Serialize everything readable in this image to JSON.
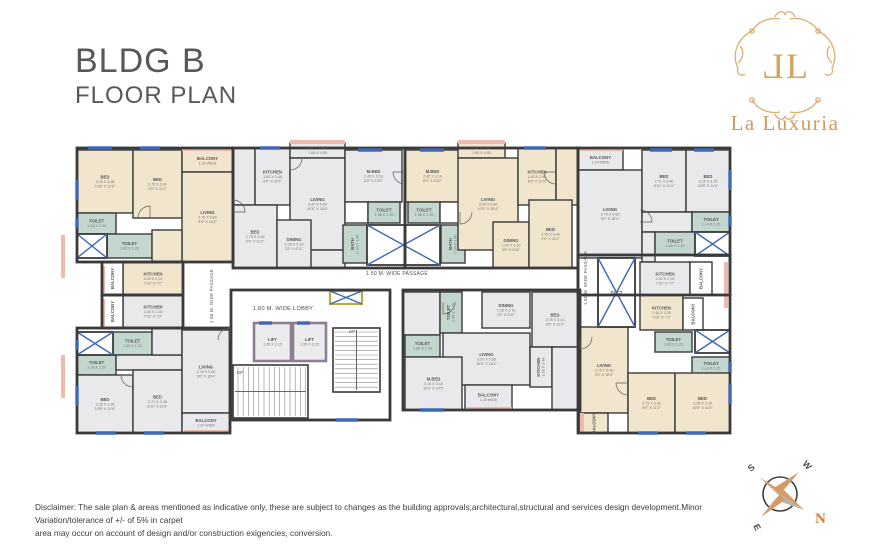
{
  "title": {
    "line1": "BLDG B",
    "line2": "FLOOR PLAN"
  },
  "logo": {
    "mono_left": "L",
    "mono_right": "L",
    "name": "La Luxuria",
    "gold": "#d9a55e"
  },
  "disclaimer": {
    "line1": "Disclaimer: The sale plan & areas mentioned as indicative only, these are subject to changes as the building approvals,architectural,structural and services design development.Minor Variation/tolerance of +/- of 5% in carpet",
    "line2": "area may occur on account of design and/or construction exigencies, conversion."
  },
  "compass": {
    "n": "N",
    "s": "S",
    "e": "E",
    "w": "W"
  },
  "colors": {
    "wall": "#3a3a3a",
    "cream": "#f1e5cd",
    "gray": "#e9e9eb",
    "teal": "#c3d7cf",
    "white": "#ffffff",
    "window": "#3f67b5",
    "rail": "#f0b9ad",
    "lift_border": "#8d7d95",
    "duct_yellow": "#b9a84e",
    "label": "#555555",
    "dims": "#76736e"
  },
  "plan": {
    "rooms": [
      {
        "ls": [
          "BED",
          "3.25 X 3.35",
          "10'8\" X 11'0\""
        ],
        "x": 77,
        "y": 150,
        "w": 56,
        "h": 63,
        "f": "c"
      },
      {
        "ls": [
          "BED",
          "2.75 X 3.41",
          "9'0\" X 11'2\""
        ],
        "x": 133,
        "y": 150,
        "w": 49,
        "h": 68,
        "f": "c"
      },
      {
        "ls": [
          "BALCONY",
          "1.20 WIDE"
        ],
        "x": 182,
        "y": 150,
        "w": 51,
        "h": 22,
        "f": "c"
      },
      {
        "ls": [
          "LIVING",
          "2.75 X 5.60",
          "9'0\" X 18'4\""
        ],
        "x": 182,
        "y": 172,
        "w": 51,
        "h": 90,
        "f": "c"
      },
      {
        "ls": [
          "TOILET",
          "1.14 X 2.20"
        ],
        "x": 77,
        "y": 213,
        "w": 39,
        "h": 21,
        "f": "t"
      },
      {
        "ls": [
          "TOILET",
          "1.85 X 1.20"
        ],
        "x": 107,
        "y": 234,
        "w": 45,
        "h": 24,
        "f": "t"
      },
      {
        "ls": [],
        "x": 152,
        "y": 230,
        "w": 30,
        "h": 32,
        "f": "c"
      },
      {
        "ls": [
          "KITCHEN",
          "2.40 X 2.20",
          "7'10\" X 7'2\""
        ],
        "x": 123,
        "y": 262,
        "w": 60,
        "h": 33,
        "f": "c"
      },
      {
        "ls": [
          "BALCONY"
        ],
        "x": 102,
        "y": 262,
        "w": 21,
        "h": 33,
        "f": "w",
        "vert": true
      },
      {
        "ls": [],
        "x": 233,
        "y": 148,
        "w": 22,
        "h": 57,
        "f": "g"
      },
      {
        "ls": [
          "KITCHEN",
          "1.83 X 3.48",
          "6'0\" X 11'5\""
        ],
        "x": 255,
        "y": 148,
        "w": 35,
        "h": 57,
        "f": "g"
      },
      {
        "ls": [
          "BALCONY",
          "1.06 X 4.05"
        ],
        "x": 290,
        "y": 143,
        "w": 55,
        "h": 15,
        "f": "g"
      },
      {
        "ls": [
          "LIVING",
          "3.20 X 5.60",
          "10'6\" X 18'4\""
        ],
        "x": 290,
        "y": 158,
        "w": 55,
        "h": 92,
        "f": "g"
      },
      {
        "ls": [],
        "x": 290,
        "y": 250,
        "w": 55,
        "h": 18,
        "f": "g"
      },
      {
        "ls": [
          "BED",
          "2.75 X 3.40",
          "9'0\" X 11'2\""
        ],
        "x": 233,
        "y": 205,
        "w": 44,
        "h": 63,
        "f": "g"
      },
      {
        "ls": [
          "DINING",
          "1.05 X 2.10",
          "3'5\" X 6'11\""
        ],
        "x": 277,
        "y": 220,
        "w": 34,
        "h": 48,
        "f": "g"
      },
      {
        "ls": [
          "M.BED",
          "2.45 X 3.10",
          "8'0\" X 10'2\""
        ],
        "x": 345,
        "y": 150,
        "w": 57,
        "h": 52,
        "f": "g"
      },
      {
        "ls": [],
        "x": 345,
        "y": 202,
        "w": 23,
        "h": 21,
        "f": "w"
      },
      {
        "ls": [
          "TOILET",
          "1.36 X 2.20"
        ],
        "x": 368,
        "y": 202,
        "w": 32,
        "h": 21,
        "f": "t"
      },
      {
        "ls": [
          "BATH",
          "0.94 X 1.80"
        ],
        "x": 343,
        "y": 225,
        "w": 24,
        "h": 38,
        "f": "t",
        "vert": true
      },
      {
        "ls": [
          "M.BED",
          "2.45 X 3.10",
          "8'0\" X 10'2\""
        ],
        "x": 405,
        "y": 150,
        "w": 55,
        "h": 52,
        "f": "c"
      },
      {
        "ls": [
          "TOILET",
          "1.36 X 2.20"
        ],
        "x": 408,
        "y": 202,
        "w": 32,
        "h": 21,
        "f": "t"
      },
      {
        "ls": [],
        "x": 440,
        "y": 202,
        "w": 23,
        "h": 21,
        "f": "w"
      },
      {
        "ls": [
          "BATH",
          "0.94 X 1.80"
        ],
        "x": 441,
        "y": 225,
        "w": 24,
        "h": 38,
        "f": "t",
        "vert": true
      },
      {
        "ls": [
          "BALCONY",
          "1.06 X 4.05"
        ],
        "x": 458,
        "y": 143,
        "w": 47,
        "h": 15,
        "f": "c"
      },
      {
        "ls": [
          "LIVING",
          "3.20 X 5.60",
          "10'6\" X 18'4\""
        ],
        "x": 458,
        "y": 158,
        "w": 60,
        "h": 92,
        "f": "c"
      },
      {
        "ls": [
          "KITCHEN",
          "1.83 X 3.48",
          "6'0\" X 11'5\""
        ],
        "x": 518,
        "y": 148,
        "w": 38,
        "h": 57,
        "f": "c"
      },
      {
        "ls": [],
        "x": 556,
        "y": 148,
        "w": 22,
        "h": 57,
        "f": "c"
      },
      {
        "ls": [
          "DINING",
          "1.05 X 2.10",
          "3'5\" X 6'11\""
        ],
        "x": 493,
        "y": 222,
        "w": 36,
        "h": 46,
        "f": "c"
      },
      {
        "ls": [
          "BED",
          "2.75 X 3.40",
          "9'0\" X 11'2\""
        ],
        "x": 529,
        "y": 200,
        "w": 43,
        "h": 68,
        "f": "c"
      },
      {
        "ls": [
          "BALCONY",
          "1.24 WIDE"
        ],
        "x": 578,
        "y": 150,
        "w": 45,
        "h": 20,
        "f": "g"
      },
      {
        "ls": [
          "LIVING",
          "2.75 X 5.60",
          "9'0\" X 18'4\""
        ],
        "x": 578,
        "y": 170,
        "w": 64,
        "h": 88,
        "f": "g"
      },
      {
        "ls": [
          "BED",
          "2.71 X 3.46",
          "8'11\" X 11'4\""
        ],
        "x": 642,
        "y": 150,
        "w": 44,
        "h": 62,
        "f": "g"
      },
      {
        "ls": [
          "BED",
          "3.25 X 3.35",
          "10'8\" X 11'0\""
        ],
        "x": 686,
        "y": 150,
        "w": 44,
        "h": 62,
        "f": "g"
      },
      {
        "ls": [],
        "x": 642,
        "y": 212,
        "w": 50,
        "h": 20,
        "f": "g"
      },
      {
        "ls": [],
        "x": 642,
        "y": 232,
        "w": 13,
        "h": 30,
        "f": "g"
      },
      {
        "ls": [
          "TOILET",
          "1.14 X 2.20"
        ],
        "x": 692,
        "y": 212,
        "w": 38,
        "h": 20,
        "f": "t"
      },
      {
        "ls": [
          "TOILET",
          "1.85 X 1.20"
        ],
        "x": 655,
        "y": 232,
        "w": 40,
        "h": 23,
        "f": "t"
      },
      {
        "ls": [
          "KITCHEN",
          "2.40 X 2.20",
          "7'10\" X 7'2\""
        ],
        "x": 640,
        "y": 262,
        "w": 50,
        "h": 33,
        "f": "g"
      },
      {
        "ls": [
          "BALCONY"
        ],
        "x": 690,
        "y": 262,
        "w": 22,
        "h": 33,
        "f": "w",
        "vert": true
      },
      {
        "ls": [
          "KITCHEN",
          "2.40 X 2.20",
          "7'10\" X 7'2\""
        ],
        "x": 123,
        "y": 295,
        "w": 60,
        "h": 33,
        "f": "g"
      },
      {
        "ls": [
          "BALCONY"
        ],
        "x": 102,
        "y": 295,
        "w": 21,
        "h": 33,
        "f": "w",
        "vert": true
      },
      {
        "ls": [
          "TOILET",
          "1.85 X 1.20"
        ],
        "x": 113,
        "y": 332,
        "w": 39,
        "h": 23,
        "f": "t"
      },
      {
        "ls": [
          "TOILET",
          "1.14 X 2.20"
        ],
        "x": 77,
        "y": 355,
        "w": 39,
        "h": 20,
        "f": "t"
      },
      {
        "ls": [],
        "x": 116,
        "y": 355,
        "w": 66,
        "h": 15,
        "f": "g"
      },
      {
        "ls": [],
        "x": 152,
        "y": 328,
        "w": 30,
        "h": 27,
        "f": "g"
      },
      {
        "ls": [
          "BED",
          "3.25 X 3.35",
          "10'8\" X 11'0\""
        ],
        "x": 77,
        "y": 375,
        "w": 56,
        "h": 58,
        "f": "g"
      },
      {
        "ls": [
          "BED",
          "2.71 X 3.46",
          "8'11\" X 11'4\""
        ],
        "x": 133,
        "y": 370,
        "w": 49,
        "h": 63,
        "f": "g"
      },
      {
        "ls": [
          "LIVING",
          "2.75 X 5.60",
          "9'0\" X 18'4\""
        ],
        "x": 182,
        "y": 330,
        "w": 48,
        "h": 83,
        "f": "g"
      },
      {
        "ls": [
          "BALCONY",
          "1.20 WIDE"
        ],
        "x": 182,
        "y": 413,
        "w": 48,
        "h": 20,
        "f": "g"
      },
      {
        "ls": [],
        "x": 403,
        "y": 292,
        "w": 37,
        "h": 43,
        "f": "g"
      },
      {
        "ls": [
          "TOILET",
          "1.36 X 2.20"
        ],
        "x": 440,
        "y": 292,
        "w": 22,
        "h": 41,
        "f": "t",
        "vert": true
      },
      {
        "ls": [
          "DINING",
          "1.05 X 2.10",
          "3'5\" X 6'11\""
        ],
        "x": 482,
        "y": 292,
        "w": 48,
        "h": 36,
        "f": "g"
      },
      {
        "ls": [
          "BED",
          "2.75 X 3.41",
          "9'0\" X 11'2\""
        ],
        "x": 532,
        "y": 292,
        "w": 46,
        "h": 55,
        "f": "g"
      },
      {
        "ls": [
          "TOILET",
          "1.85 X 1.20"
        ],
        "x": 405,
        "y": 335,
        "w": 35,
        "h": 22,
        "f": "t"
      },
      {
        "ls": [
          "LIVING",
          "3.20 X 5.60",
          "10'6\" X 18'4\""
        ],
        "x": 443,
        "y": 333,
        "w": 87,
        "h": 52,
        "f": "g"
      },
      {
        "ls": [
          "M.BED",
          "3.10 X 3.10",
          "10'2\" X 10'2\""
        ],
        "x": 405,
        "y": 357,
        "w": 57,
        "h": 53,
        "f": "g"
      },
      {
        "ls": [
          "KITCHEN",
          "1.83 X 3.48"
        ],
        "x": 530,
        "y": 347,
        "w": 22,
        "h": 40,
        "f": "g",
        "vert": true
      },
      {
        "ls": [],
        "x": 552,
        "y": 347,
        "w": 26,
        "h": 63,
        "f": "g"
      },
      {
        "ls": [
          "BALCONY",
          "1.20 WIDE"
        ],
        "x": 465,
        "y": 385,
        "w": 47,
        "h": 25,
        "f": "g"
      },
      {
        "ls": [
          "DUCT"
        ],
        "x": 598,
        "y": 258,
        "w": 37,
        "h": 69,
        "f": "w"
      },
      {
        "ls": [
          "KITCHEN",
          "2.40 X 2.20",
          "7'10\" X 7'2\""
        ],
        "x": 640,
        "y": 295,
        "w": 43,
        "h": 35,
        "f": "c"
      },
      {
        "ls": [
          "BALCONY"
        ],
        "x": 683,
        "y": 298,
        "w": 20,
        "h": 32,
        "f": "w",
        "vert": true
      },
      {
        "ls": [
          "TOILET",
          "1.85 X 1.20"
        ],
        "x": 655,
        "y": 332,
        "w": 37,
        "h": 20,
        "f": "t"
      },
      {
        "ls": [
          "TOILET",
          "1.14 X 2.20"
        ],
        "x": 692,
        "y": 357,
        "w": 38,
        "h": 18,
        "f": "t"
      },
      {
        "ls": [
          "LIVING",
          "2.75 X 5.60",
          "9'0\" X 18'4\""
        ],
        "x": 580,
        "y": 327,
        "w": 48,
        "h": 86,
        "f": "c"
      },
      {
        "ls": [
          "BED",
          "2.75 X 3.41",
          "9'0\" X 11'2\""
        ],
        "x": 628,
        "y": 373,
        "w": 47,
        "h": 60,
        "f": "c"
      },
      {
        "ls": [
          "BED",
          "3.25 X 3.35",
          "10'8\" X 11'0\""
        ],
        "x": 675,
        "y": 373,
        "w": 55,
        "h": 60,
        "f": "c"
      },
      {
        "ls": [
          "BALCONY"
        ],
        "x": 580,
        "y": 413,
        "w": 28,
        "h": 20,
        "f": "c",
        "vert": true
      }
    ],
    "lifts": [
      {
        "ls": [
          "LIFT",
          "1.95 X 2.15"
        ],
        "x": 254,
        "y": 323,
        "w": 37,
        "h": 38
      },
      {
        "ls": [
          "LIFT",
          "1.95 X 2.15"
        ],
        "x": 293,
        "y": 323,
        "w": 33,
        "h": 38
      }
    ],
    "xboxes": [
      {
        "x": 77,
        "y": 234,
        "w": 30,
        "h": 24,
        "s": "plain"
      },
      {
        "x": 367,
        "y": 225,
        "w": 73,
        "h": 40,
        "s": "plain"
      },
      {
        "x": 695,
        "y": 232,
        "w": 35,
        "h": 24,
        "s": "plain"
      },
      {
        "x": 77,
        "y": 332,
        "w": 36,
        "h": 23,
        "s": "plain"
      },
      {
        "x": 598,
        "y": 258,
        "w": 37,
        "h": 69,
        "s": "plain"
      },
      {
        "x": 695,
        "y": 330,
        "w": 35,
        "h": 23,
        "s": "plain"
      },
      {
        "x": 330,
        "y": 291,
        "w": 32,
        "h": 13,
        "s": "yellow"
      }
    ],
    "windows": [
      [
        88,
        148,
        112,
        148
      ],
      [
        140,
        148,
        160,
        148
      ],
      [
        260,
        148,
        280,
        148
      ],
      [
        358,
        150,
        382,
        150
      ],
      [
        420,
        150,
        444,
        150
      ],
      [
        524,
        148,
        546,
        148
      ],
      [
        650,
        150,
        672,
        150
      ],
      [
        694,
        150,
        714,
        150
      ],
      [
        77,
        180,
        77,
        200
      ],
      [
        77,
        218,
        77,
        228
      ],
      [
        77,
        340,
        77,
        350
      ],
      [
        77,
        386,
        77,
        406
      ],
      [
        730,
        170,
        730,
        190
      ],
      [
        730,
        216,
        730,
        226
      ],
      [
        730,
        362,
        730,
        372
      ],
      [
        730,
        384,
        730,
        404
      ],
      [
        96,
        433,
        116,
        433
      ],
      [
        144,
        433,
        164,
        433
      ],
      [
        638,
        433,
        658,
        433
      ],
      [
        686,
        433,
        706,
        433
      ],
      [
        336,
        420,
        358,
        420
      ],
      [
        259,
        323,
        272,
        323
      ],
      [
        297,
        323,
        310,
        323
      ],
      [
        420,
        410,
        444,
        410
      ]
    ],
    "rails": [
      [
        182,
        149,
        233,
        149
      ],
      [
        290,
        142,
        345,
        142
      ],
      [
        458,
        142,
        505,
        142
      ],
      [
        578,
        149,
        623,
        149
      ],
      [
        103,
        266,
        103,
        293
      ],
      [
        103,
        299,
        103,
        326
      ],
      [
        63,
        235,
        63,
        278
      ],
      [
        63,
        355,
        63,
        398
      ],
      [
        467,
        409,
        512,
        409
      ],
      [
        184,
        432,
        230,
        432
      ],
      [
        726,
        262,
        726,
        308
      ],
      [
        582,
        413,
        582,
        432
      ]
    ],
    "outlines": [
      [
        77,
        148,
        156,
        114
      ],
      [
        102,
        262,
        81,
        33
      ],
      [
        233,
        148,
        172,
        120
      ],
      [
        405,
        148,
        173,
        120
      ],
      [
        578,
        148,
        152,
        147
      ],
      [
        77,
        328,
        153,
        105
      ],
      [
        102,
        295,
        81,
        33
      ],
      [
        403,
        290,
        177,
        120
      ],
      [
        578,
        255,
        152,
        178
      ],
      [
        231,
        290,
        159,
        130
      ]
    ],
    "stairs": [
      {
        "x": 233,
        "y": 365,
        "w": 75,
        "h": 53,
        "type": "v"
      },
      {
        "x": 333,
        "y": 328,
        "w": 47,
        "h": 64,
        "type": "h"
      }
    ],
    "doors": [
      [
        150,
        218,
        12,
        180
      ],
      [
        233,
        212,
        12,
        270
      ],
      [
        405,
        172,
        12,
        90
      ],
      [
        460,
        212,
        12,
        0
      ],
      [
        556,
        172,
        12,
        90
      ],
      [
        640,
        222,
        12,
        270
      ],
      [
        133,
        375,
        12,
        90
      ],
      [
        230,
        340,
        12,
        180
      ],
      [
        443,
        302,
        12,
        0
      ],
      [
        628,
        383,
        12,
        90
      ],
      [
        290,
        158,
        12,
        0
      ],
      [
        580,
        337,
        12,
        0
      ]
    ],
    "texts": [
      {
        "t": "1.80 M. WIDE LOBBY",
        "x": 283,
        "y": 310,
        "s": 5.6,
        "name": "lobby-label"
      },
      {
        "t": "1.50 M. WIDE PASSAGE",
        "x": 397,
        "y": 275,
        "s": 5,
        "name": "passage-label"
      },
      {
        "t": "1.50 M. WIDE PASSAGE",
        "x": 213,
        "y": 296,
        "s": 4.3,
        "r": -90,
        "name": "passage-label-vertical"
      },
      {
        "t": "1.50 M. WIDE PASSAGE",
        "x": 587,
        "y": 278,
        "s": 4.3,
        "r": -90,
        "name": "passage-label-vertical"
      },
      {
        "t": "UP",
        "x": 240,
        "y": 374,
        "s": 4.5,
        "name": "stairs-up-label"
      },
      {
        "t": "UP",
        "x": 352,
        "y": 333,
        "s": 4.5,
        "name": "stairs-up-label"
      }
    ]
  }
}
